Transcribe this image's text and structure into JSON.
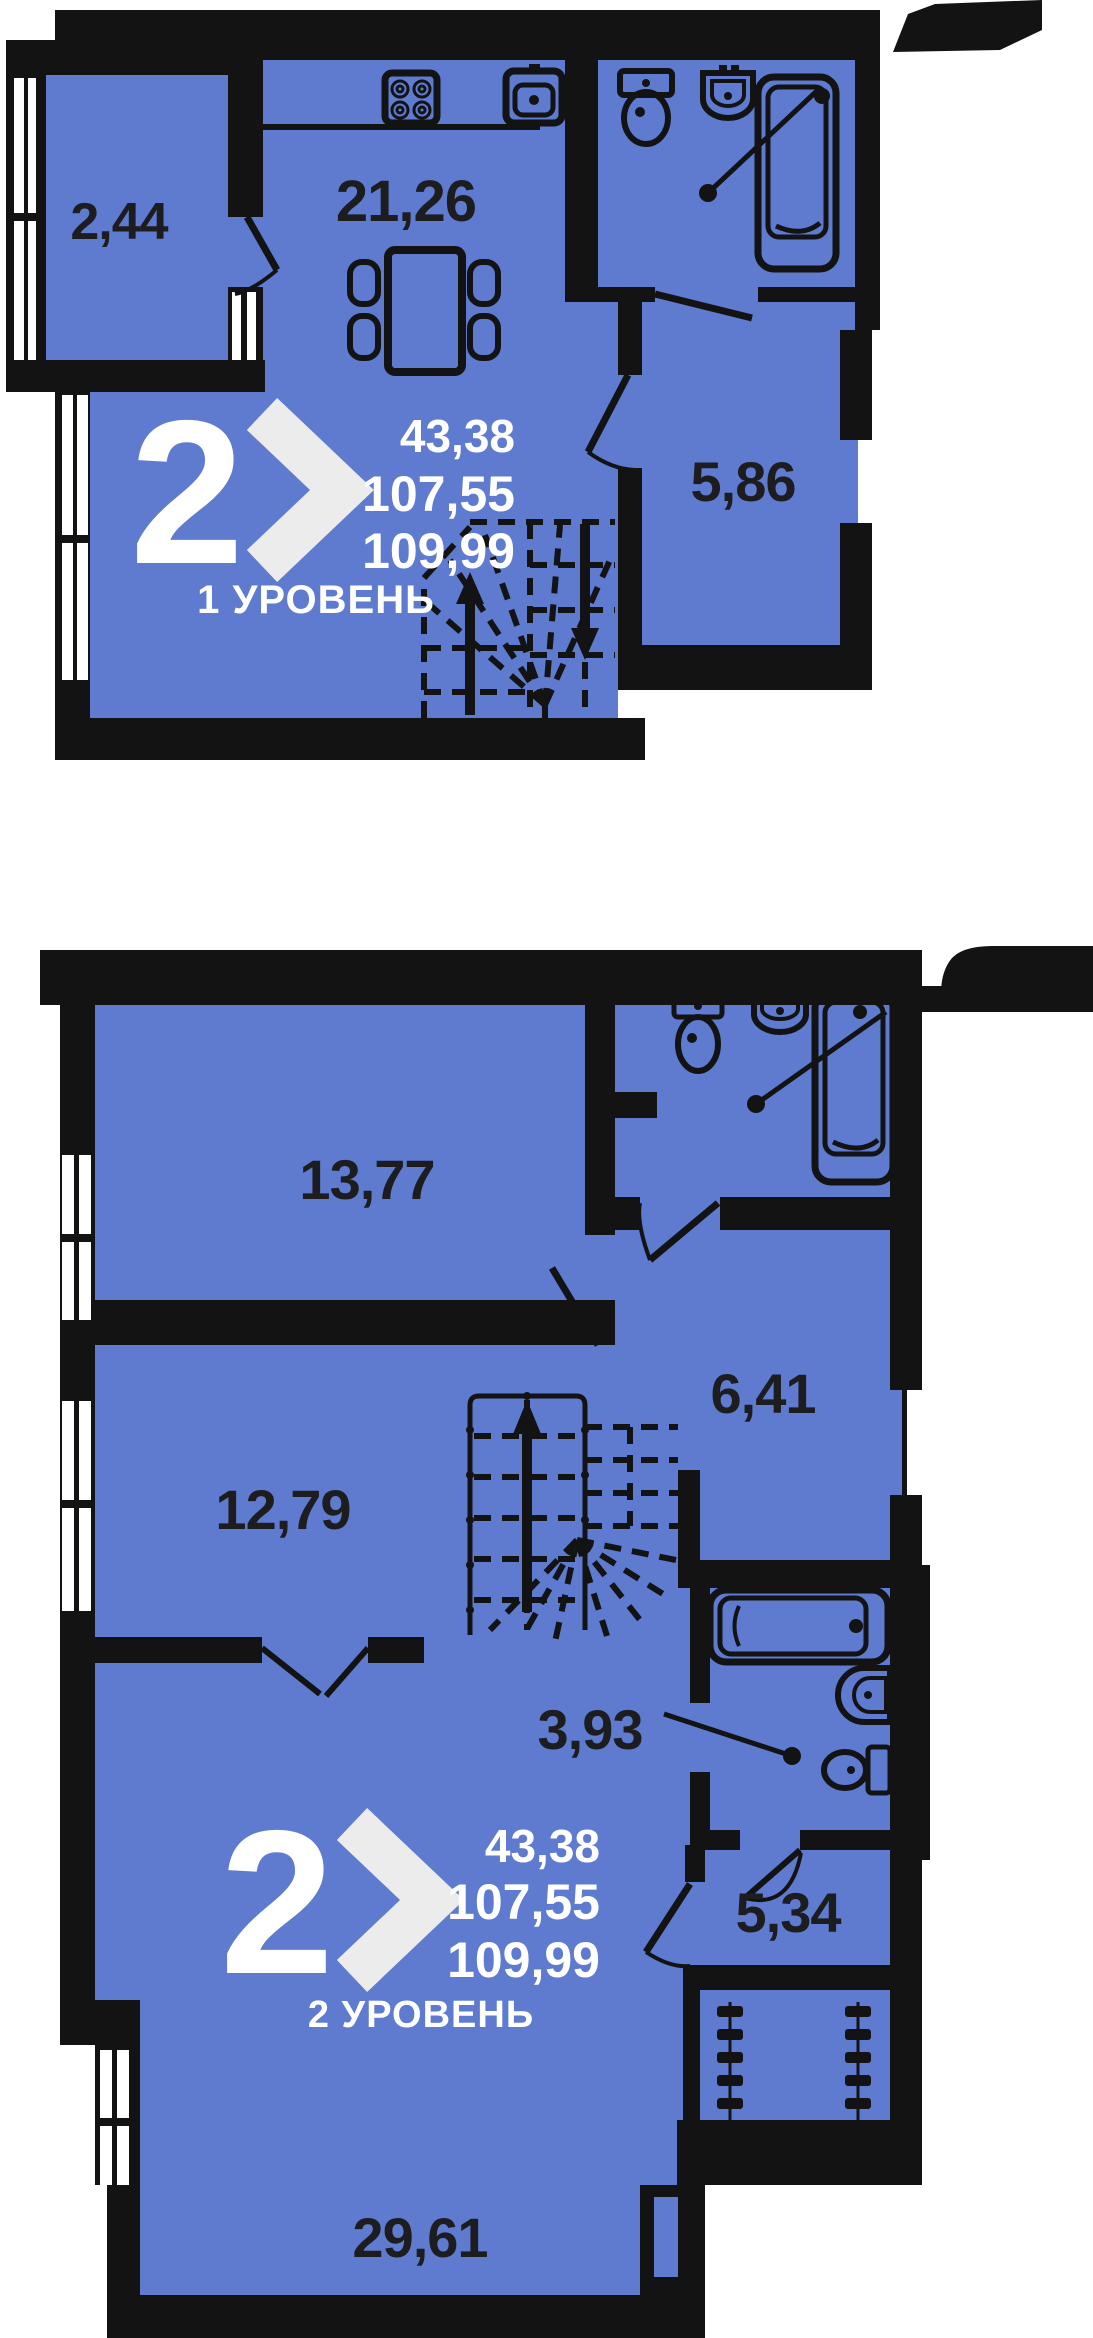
{
  "colors": {
    "room_fill": "#5e7bd0",
    "wall": "#131313",
    "area_text": "#1d1d20",
    "badge_text": "#ffffff",
    "chevron": "#ececec"
  },
  "level1": {
    "rooms": [
      {
        "name": "balcony",
        "area": "2,44"
      },
      {
        "name": "kitchen-living",
        "area": "21,26"
      },
      {
        "name": "hallway",
        "area": "5,86"
      }
    ],
    "badge": {
      "rooms_count": "2",
      "area_living": "43,38",
      "area_main": "107,55",
      "area_total": "109,99",
      "level_label": "1 УРОВЕНЬ"
    }
  },
  "level2": {
    "rooms": [
      {
        "name": "bedroom-1",
        "area": "13,77"
      },
      {
        "name": "bedroom-2",
        "area": "12,79"
      },
      {
        "name": "hall",
        "area": "6,41"
      },
      {
        "name": "corridor",
        "area": "3,93"
      },
      {
        "name": "inner-room",
        "area": "5,34"
      },
      {
        "name": "living-room",
        "area": "29,61"
      }
    ],
    "badge": {
      "rooms_count": "2",
      "area_living": "43,38",
      "area_main": "107,55",
      "area_total": "109,99",
      "level_label": "2 УРОВЕНЬ"
    }
  }
}
